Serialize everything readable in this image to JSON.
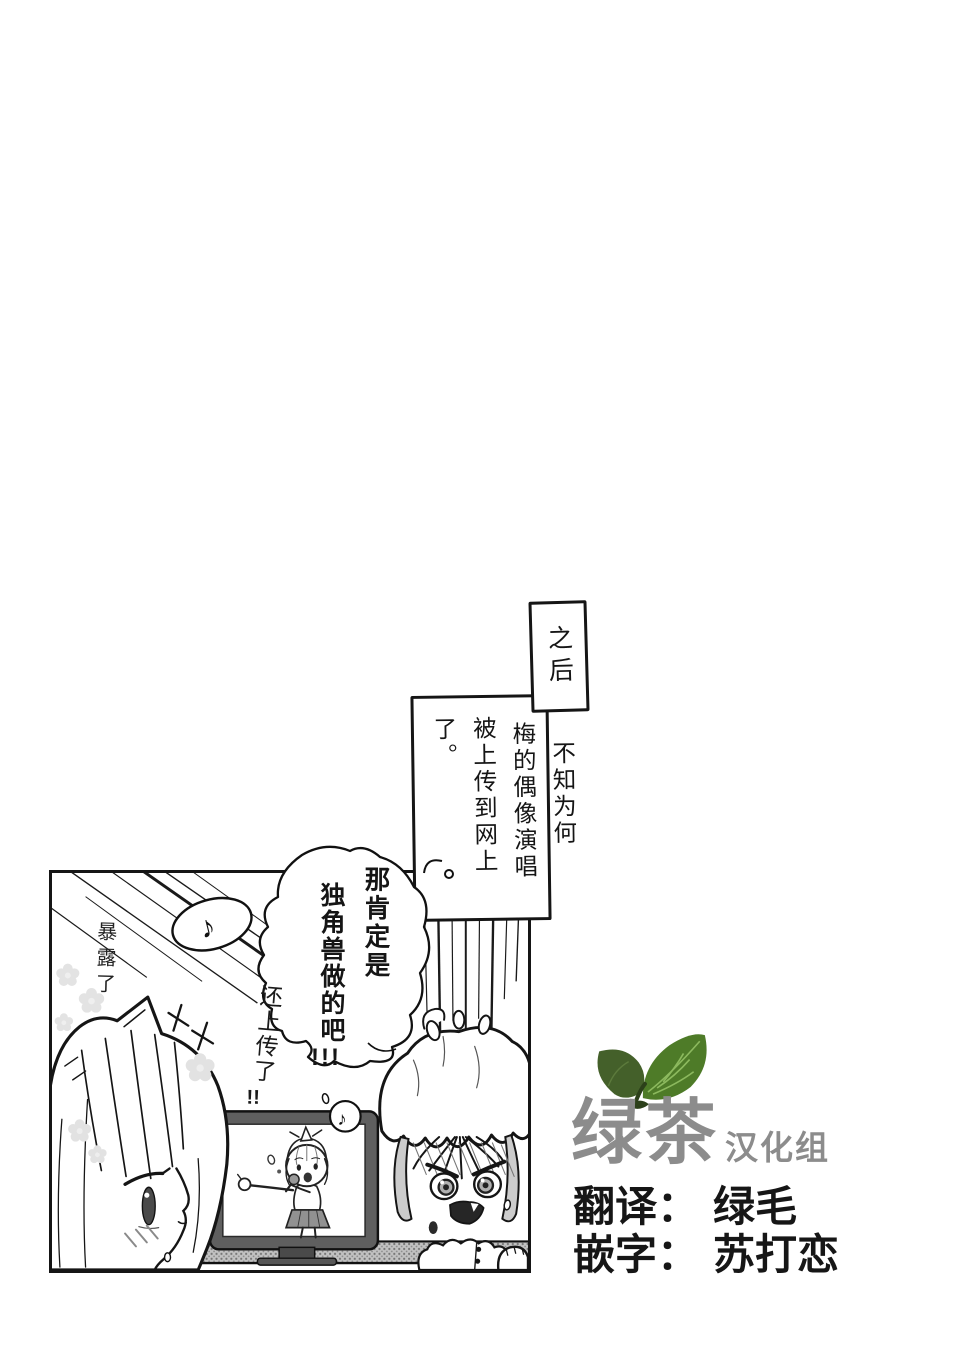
{
  "page": {
    "background": "#ffffff"
  },
  "captions": {
    "after": "之后",
    "narration": {
      "col1": "不知为何",
      "col2": "梅的偶像演唱",
      "col3": "被上传到网上了。"
    }
  },
  "bubble": {
    "col1": "那肯定是",
    "col2": "独角兽做的吧",
    "col2_bang": "!!!",
    "aside": "还上传了",
    "aside_bang": "!!"
  },
  "panel": {
    "sfx_exposed": "暴露了",
    "music_note": "♪",
    "tv_music_note": "♪"
  },
  "credits": {
    "group_main": "绿茶",
    "group_suffix": "汉化组",
    "translator_label": "翻译：",
    "translator_name": "绿毛",
    "typesetter_label": "嵌字：",
    "typesetter_name": "苏打恋",
    "colors": {
      "logo_text": "#8c8c8c",
      "leaf_dark": "#44602a",
      "leaf_bright": "#4e7b28",
      "leaf_vein": "#8cb95e",
      "ink": "#151515"
    }
  }
}
